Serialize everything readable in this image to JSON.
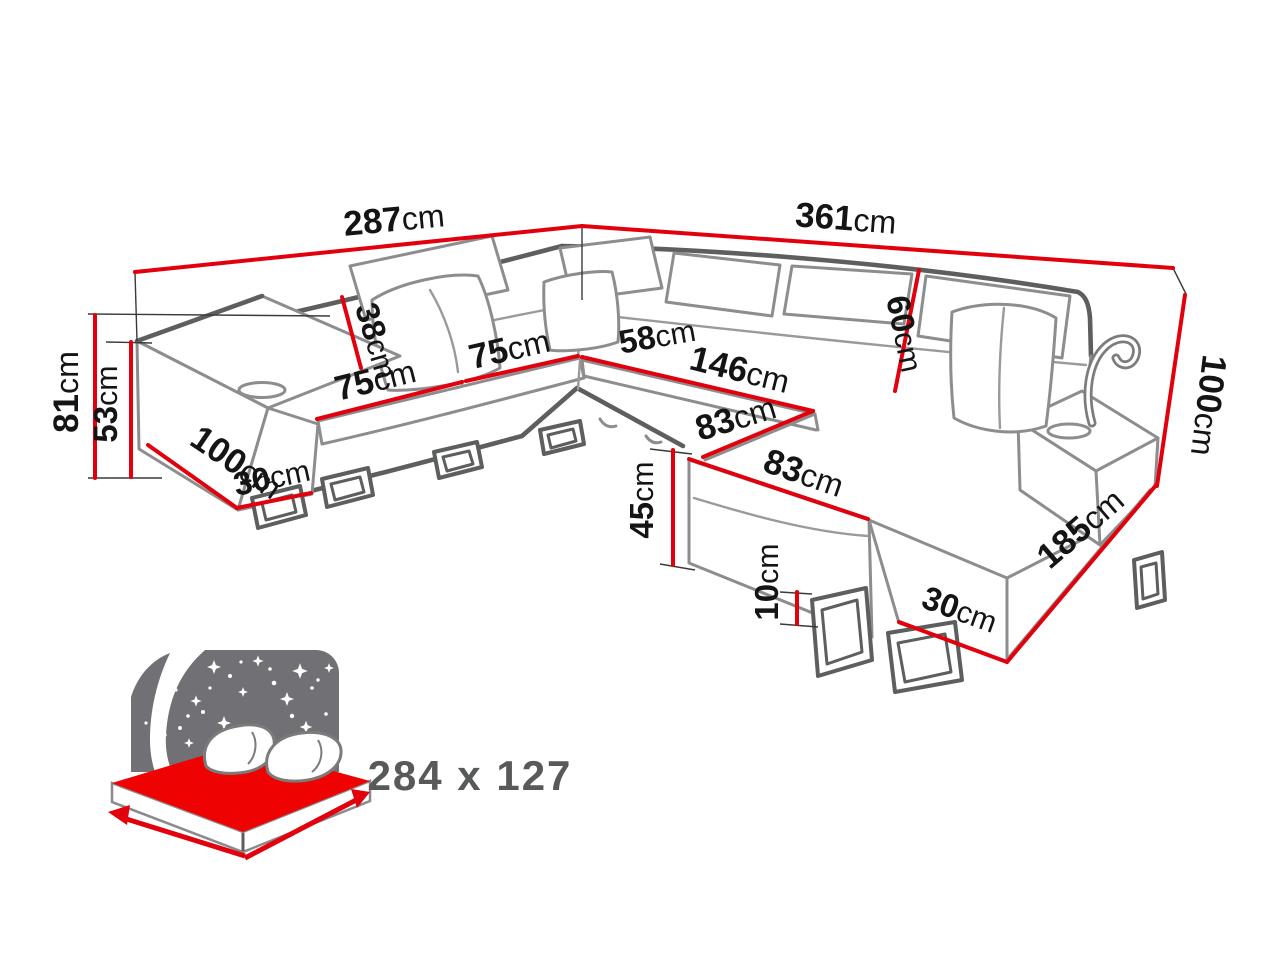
{
  "dimensions": {
    "dim_287": {
      "value": "287",
      "unit": "cm"
    },
    "dim_361": {
      "value": "361",
      "unit": "cm"
    },
    "dim_81": {
      "value": "81",
      "unit": "cm"
    },
    "dim_53": {
      "value": "53",
      "unit": "cm"
    },
    "dim_100_left": {
      "value": "100",
      "unit": "cm"
    },
    "dim_30_left": {
      "value": "30",
      "unit": "cm"
    },
    "dim_38": {
      "value": "38",
      "unit": "cm"
    },
    "dim_75_left": {
      "value": "75",
      "unit": "cm"
    },
    "dim_75_right": {
      "value": "75",
      "unit": "cm"
    },
    "dim_58": {
      "value": "58",
      "unit": "cm"
    },
    "dim_146": {
      "value": "146",
      "unit": "cm"
    },
    "dim_83_upper": {
      "value": "83",
      "unit": "cm"
    },
    "dim_83_lower": {
      "value": "83",
      "unit": "cm"
    },
    "dim_60": {
      "value": "60",
      "unit": "cm"
    },
    "dim_100_right": {
      "value": "100",
      "unit": "cm"
    },
    "dim_185": {
      "value": "185",
      "unit": "cm"
    },
    "dim_30_right": {
      "value": "30",
      "unit": "cm"
    },
    "dim_45": {
      "value": "45",
      "unit": "cm"
    },
    "dim_10": {
      "value": "10",
      "unit": "cm"
    }
  },
  "sleeping_area": {
    "label": "284 x 127"
  },
  "colors": {
    "dimension_red": "#e2000c",
    "mattress_red": "#ee0202",
    "outline_gray": "#8d8d8d",
    "outline_dark": "#5d5e5e",
    "text_black": "#141414",
    "icon_sky_gray": "#717175",
    "icon_text_gray": "#58595b"
  }
}
